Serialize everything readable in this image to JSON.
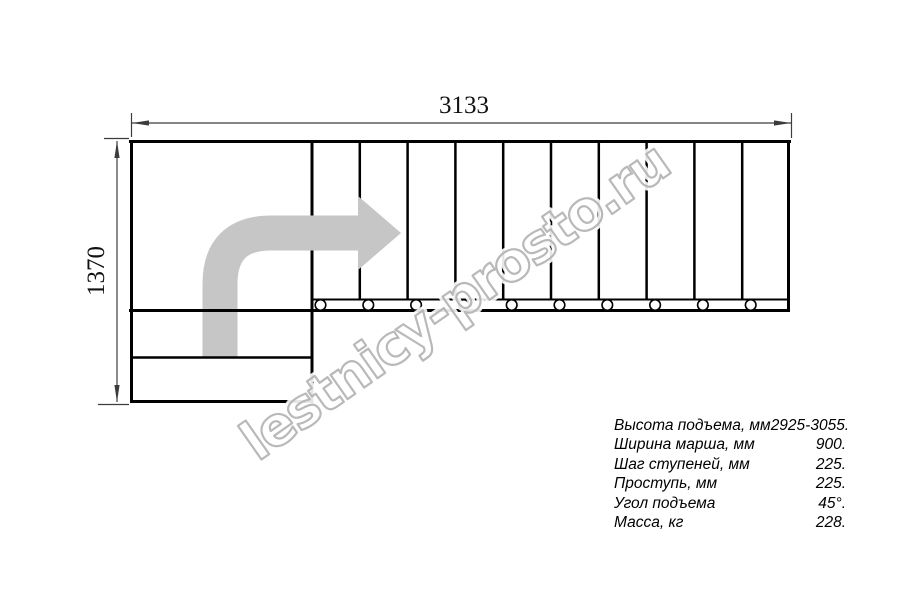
{
  "colors": {
    "line": "#000000",
    "dim": "#3c3c3c",
    "arrow": "#c6c6c6",
    "wm": "#b2b2b2"
  },
  "dimensions": {
    "width_label": "3133",
    "height_label": "1370"
  },
  "drawing": {
    "type": "staircase-plan-top-view",
    "tread_count": 10,
    "fastener_count": 10,
    "winder_step_count": 2
  },
  "watermark": {
    "text": "lestnicy-prosto.ru"
  },
  "specs": {
    "rows": [
      {
        "label": "Высота подъема, мм",
        "value": "2925-3055."
      },
      {
        "label": "Ширина марша, мм",
        "value": "900."
      },
      {
        "label": "Шаг ступеней, мм",
        "value": "225."
      },
      {
        "label": "Проступь, мм",
        "value": "225."
      },
      {
        "label": "Угол подъема",
        "value": "45°."
      },
      {
        "label": "Масса, кг",
        "value": "228."
      }
    ]
  }
}
